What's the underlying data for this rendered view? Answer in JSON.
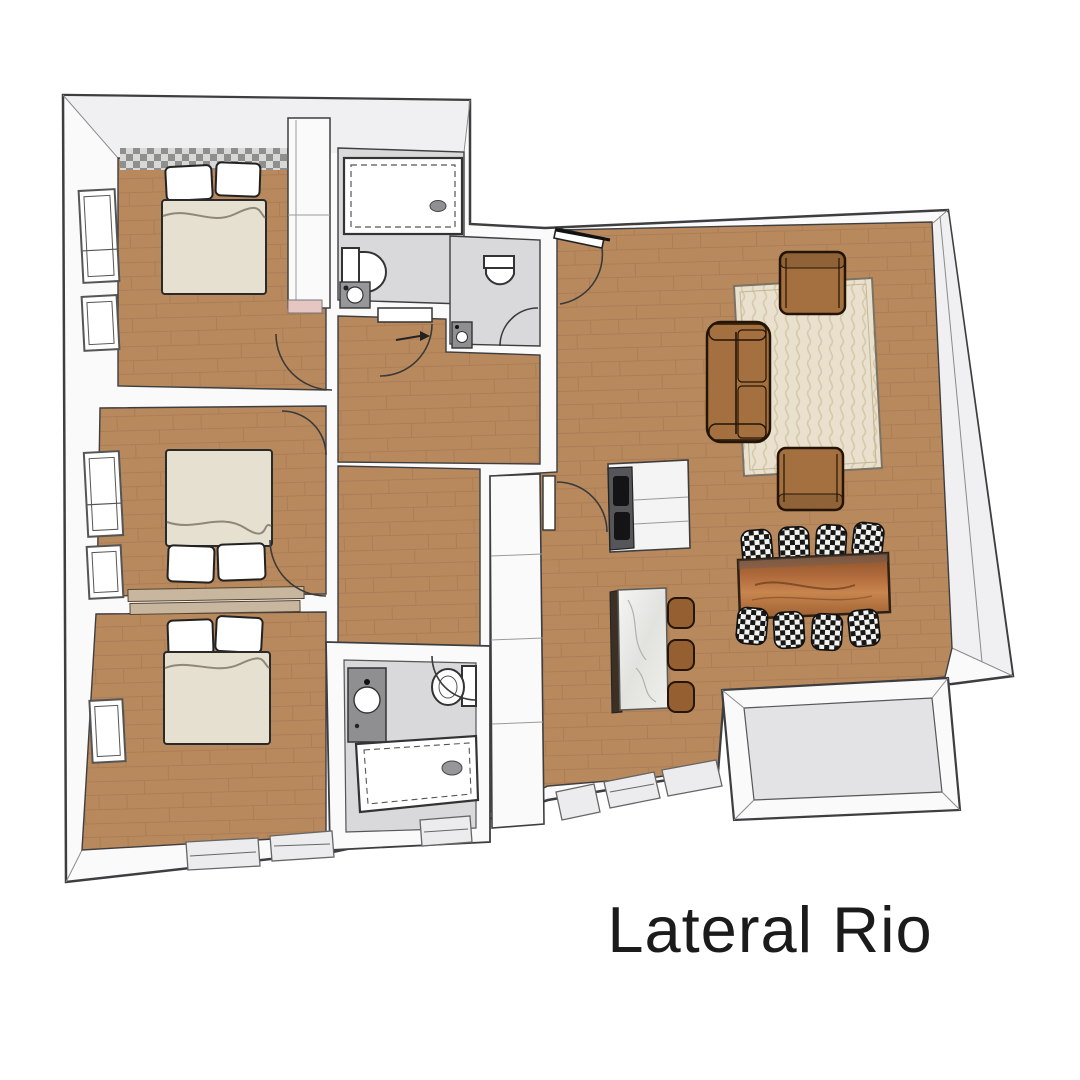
{
  "title": {
    "label": "Lateral Rio"
  },
  "colors": {
    "wall_fill": "#fafafa",
    "wall_shade": "#f0f0f2",
    "outline": "#3e3e40",
    "wood_floor": "#b9895e",
    "wood_line": "#a0724b",
    "tile_floor": "#d9d9db",
    "rug": "#e9e1cd",
    "rug_line": "#d6c9ac",
    "rug_border": "#7a7264",
    "sofa": "#a4703f",
    "furniture_outline": "#241507",
    "stool": "#965f31",
    "island_base": "#3c2f23",
    "cooktop": "#55565a",
    "burner": "#141416",
    "balcony_floor": "#e3e3e5",
    "panel": "#ececee",
    "duvet": "#e6e0d1",
    "pillow": "#ffffff",
    "ledge": "#c8b79e",
    "pink": "#e5c6c2",
    "checker_light": "#d8d8d6",
    "checker_dark": "#8f8f8d",
    "text": "#1b1b1b"
  },
  "icons": [
    "double-bed-icon",
    "pillow-icon",
    "wardrobe-icon",
    "window-icon",
    "bathtub-icon",
    "toilet-icon",
    "sink-icon",
    "door-arc-icon",
    "direction-arrow-icon",
    "sofa-icon",
    "armchair-icon",
    "rug-icon",
    "dining-table-icon",
    "dining-chair-icon",
    "kitchen-island-icon",
    "bar-stool-icon",
    "cooktop-icon",
    "cabinet-icon",
    "balcony-icon",
    "sliding-door-icon"
  ]
}
